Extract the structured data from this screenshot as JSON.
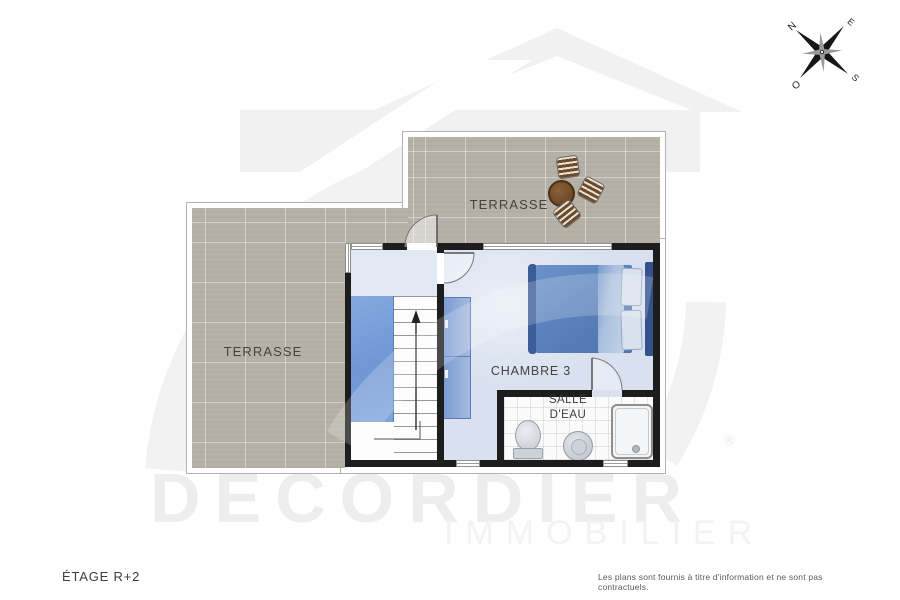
{
  "floorplan": {
    "level_label": "ÉTAGE R+2",
    "disclaimer": "Les plans sont fournis à titre d'information et ne sont pas contractuels.",
    "rooms": {
      "terrace_left": "TERRASSE",
      "terrace_top": "TERRASSE",
      "bedroom": "CHAMBRE 3",
      "bathroom_line1": "SALLE",
      "bathroom_line2": "D'EAU"
    },
    "compass": {
      "north": "N",
      "east": "E",
      "south": "S",
      "west": "O"
    },
    "watermark": {
      "brand": "DECORDIER",
      "registered": "®",
      "subtitle": "IMMOBILIER"
    },
    "colors": {
      "terrace_tile": "#b6b2a8",
      "interior_floor": "#d9e1f0",
      "stair_void": "#7da2dc",
      "bed_blue": "#5b82bd",
      "wall": "#1d1d1d"
    }
  }
}
